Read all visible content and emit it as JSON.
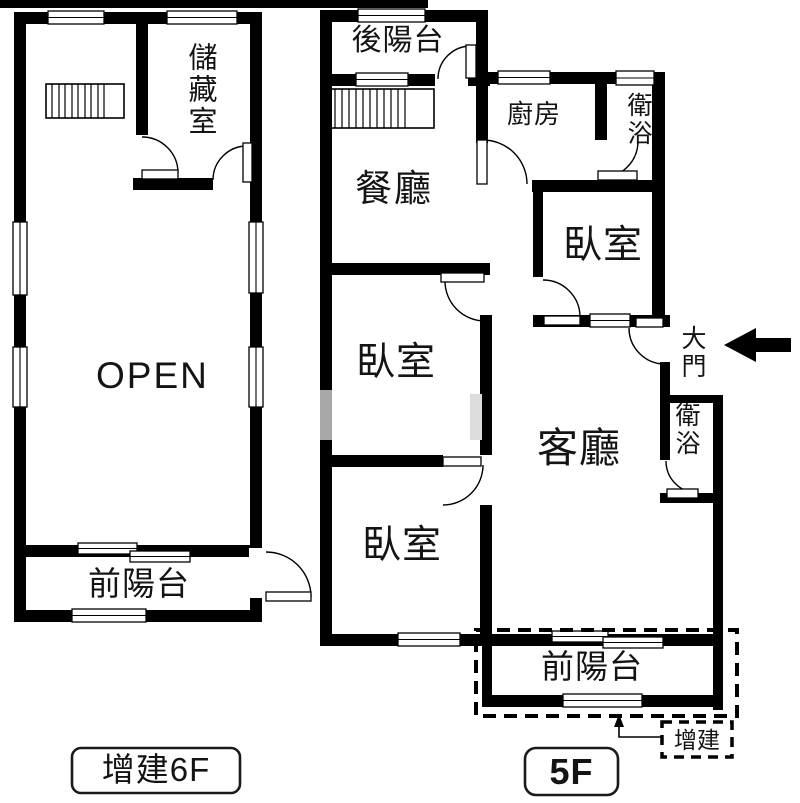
{
  "colors": {
    "wall": "#000000",
    "background": "#ffffff",
    "text": "#141414"
  },
  "floor6": {
    "tag": "增建6F",
    "rooms": {
      "storage": "儲藏室",
      "open_area": "OPEN",
      "front_balcony": "前陽台"
    }
  },
  "floor5": {
    "tag": "5F",
    "rooms": {
      "back_balcony": "後陽台",
      "kitchen": "廚房",
      "bath_top": "衛浴",
      "dining": "餐廳",
      "bedroom_top": "臥室",
      "main_door": "大門",
      "bath_right": "衛浴",
      "living": "客廳",
      "bedroom_mid": "臥室",
      "bedroom_bottom": "臥室",
      "front_balcony": "前陽台",
      "addition_note": "增建"
    }
  }
}
